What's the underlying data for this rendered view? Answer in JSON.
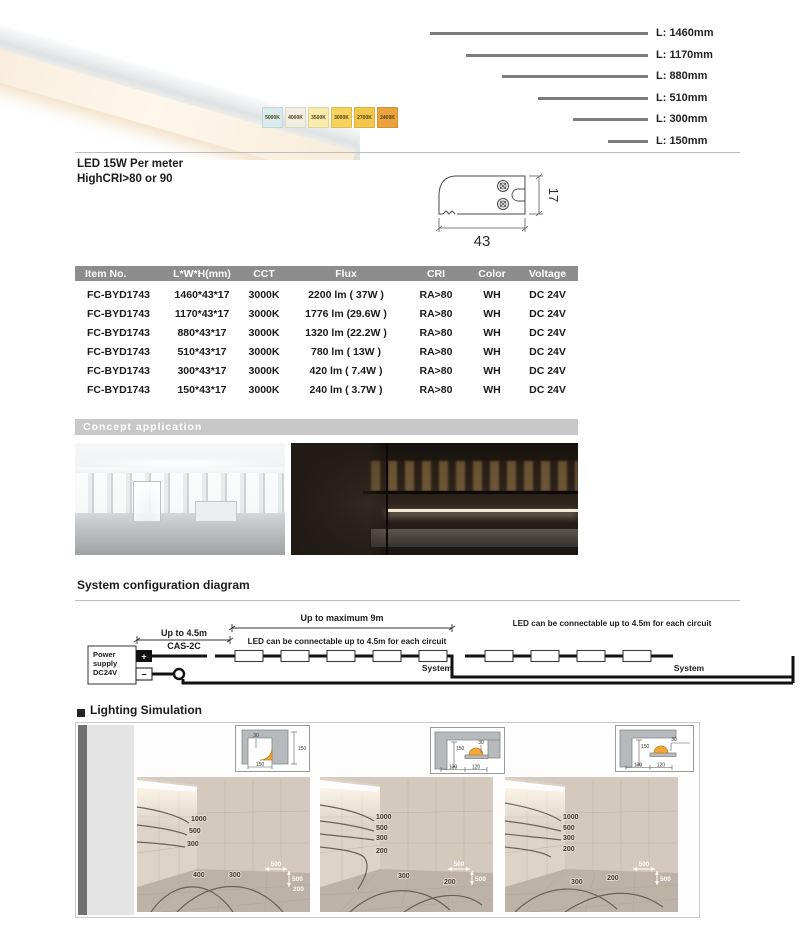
{
  "header": {
    "power": "LED  15W Per meter",
    "cri": "HighCRI>80 or 90"
  },
  "cct_swatches": [
    {
      "label": "5000K",
      "color": "#d9eced"
    },
    {
      "label": "4000K",
      "color": "#f2efe2"
    },
    {
      "label": "3500K",
      "color": "#f9ecab"
    },
    {
      "label": "3000K",
      "color": "#f6d35c"
    },
    {
      "label": "2700K",
      "color": "#f2c64b"
    },
    {
      "label": "2400K",
      "color": "#e9a23c"
    }
  ],
  "lengths": [
    {
      "label": "L: 1460mm",
      "bar_w": "218px"
    },
    {
      "label": "L: 1170mm",
      "bar_w": "182px"
    },
    {
      "label": "L: 880mm",
      "bar_w": "146px"
    },
    {
      "label": "L: 510mm",
      "bar_w": "110px"
    },
    {
      "label": "L: 300mm",
      "bar_w": "75px"
    },
    {
      "label": "L: 150mm",
      "bar_w": "40px"
    }
  ],
  "cross_section": {
    "width_mm": "43",
    "height_mm": "17"
  },
  "table": {
    "headers": [
      "Item No.",
      "L*W*H(mm)",
      "CCT",
      "Flux",
      "CRI",
      "Color",
      "Voltage"
    ],
    "rows": [
      [
        "FC-BYD1743",
        "1460*43*17",
        "3000K",
        "2200 lm (  37W )",
        "RA>80",
        "WH",
        "DC 24V"
      ],
      [
        "FC-BYD1743",
        "1170*43*17",
        "3000K",
        "1776 lm (29.6W )",
        "RA>80",
        "WH",
        "DC 24V"
      ],
      [
        "FC-BYD1743",
        "880*43*17",
        "3000K",
        "1320 lm (22.2W )",
        "RA>80",
        "WH",
        "DC 24V"
      ],
      [
        "FC-BYD1743",
        "510*43*17",
        "3000K",
        "780  lm (  13W )",
        "RA>80",
        "WH",
        "DC 24V"
      ],
      [
        "FC-BYD1743",
        "300*43*17",
        "3000K",
        "420  lm ( 7.4W )",
        "RA>80",
        "WH",
        "DC 24V"
      ],
      [
        "FC-BYD1743",
        "150*43*17",
        "3000K",
        "240  lm ( 3.7W )",
        "RA>80",
        "WH",
        "DC 24V"
      ]
    ]
  },
  "concept_title": "Concept  application",
  "system": {
    "title": "System configuration diagram",
    "dim_9m": "Up to maximum 9m",
    "dim_45": "Up to 4.5m",
    "cable": "CAS-2C",
    "circuit1": "LED can be connectable up to 4.5m for each circuit",
    "circuit2": "LED can be connectable up to 4.5m for each circuit",
    "ps_line1": "Power",
    "ps_line2": "supply",
    "ps_line3": "DC24V",
    "plus": "+",
    "minus": "−",
    "system1": "System",
    "system2": "System"
  },
  "simulation": {
    "title": "Lighting Simulation",
    "insets": [
      {
        "d1": "30",
        "d2": "150",
        "d3": "150",
        "d4": ""
      },
      {
        "d1": "150",
        "d2": "30",
        "d3": "130",
        "d4": "120"
      },
      {
        "d1": "150",
        "d2": "30",
        "d3": "130",
        "d4": "120"
      }
    ],
    "rooms": [
      {
        "wall": [
          "1000",
          "500",
          "300"
        ],
        "floor": [
          "400",
          "300"
        ],
        "legend": [
          "500",
          "500",
          "200"
        ]
      },
      {
        "wall": [
          "1000",
          "500",
          "300",
          "200"
        ],
        "floor": [
          "300",
          "200"
        ],
        "legend": [
          "500",
          "500"
        ]
      },
      {
        "wall": [
          "1000",
          "500",
          "300",
          "200"
        ],
        "floor": [
          "300",
          "200"
        ],
        "legend": [
          "500",
          "500"
        ]
      }
    ]
  }
}
